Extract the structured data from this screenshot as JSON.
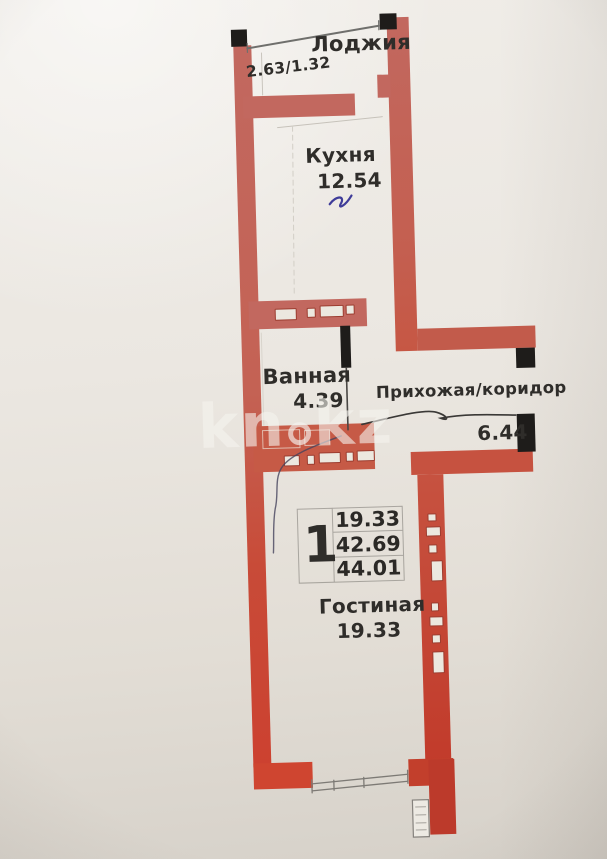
{
  "document": {
    "type": "apartment-floor-plan-scan",
    "watermark_site": "kn.kz"
  },
  "watermark": {
    "part1": "kn",
    "part2": "kz"
  },
  "rooms": [
    {
      "name": "Лоджия",
      "area": "2.63/1.32"
    },
    {
      "name": "Кухня",
      "area": "12.54"
    },
    {
      "name": "Ванная",
      "area": "4.39"
    },
    {
      "name": "Прихожая/коридор",
      "area": "6.44"
    },
    {
      "name": "Гостиная",
      "area": "19.33"
    }
  ],
  "legend": {
    "rooms_count": "1",
    "living_area": "19.33",
    "usable_area": "42.69",
    "total_area": "44.01"
  },
  "colors": {
    "wall_upper": "#c2685f",
    "wall_mid": "#c65a46",
    "wall_lower": "#c23b2b",
    "wall_black": "#1e1c1a",
    "paper": "#eae6e0",
    "ink_blue": "#3f3c99",
    "ink_dark": "#3a3836",
    "text": "#2f2d2a"
  }
}
